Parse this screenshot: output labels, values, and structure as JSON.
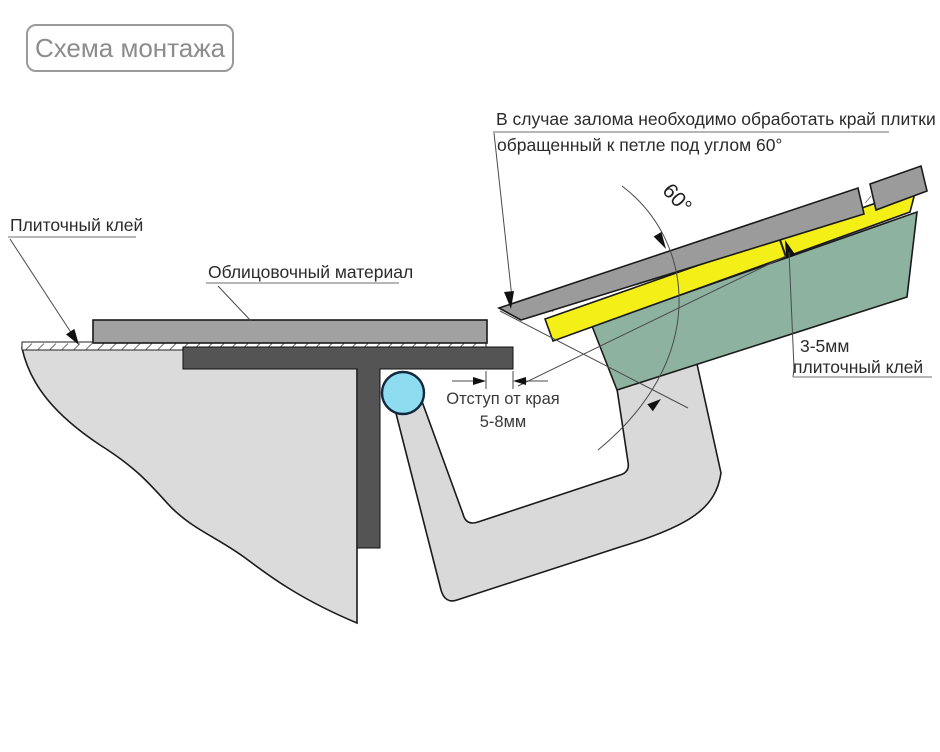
{
  "title": {
    "label": "Схема монтажа"
  },
  "note": {
    "line1": "В случае залома необходимо обработать край плитки",
    "line2": "обращенный к петле под углом 60°"
  },
  "labels": {
    "tile_adhesive": "Плиточный клей",
    "facing_material": "Облицовочный материал",
    "edge_offset_line1": "Отступ от края",
    "edge_offset_line2": "5-8мм",
    "adhesive_thickness_line1": "3-5мм",
    "adhesive_thickness_line2": "плиточный клей",
    "angle": "60°"
  },
  "colors": {
    "wall_gray": "#dbdbdb",
    "channel_gray": "#d9d9d9",
    "slab_gray": "#a1a1a1",
    "tile_gray": "#9b9b9b",
    "frame_dark": "#545454",
    "adhesive_yellow": "#f3ef17",
    "panel_green": "#8eb2a0",
    "hinge_blue": "#8edcef",
    "title_gray": "#8c8c8c",
    "text_dark": "#2b2b2b"
  }
}
